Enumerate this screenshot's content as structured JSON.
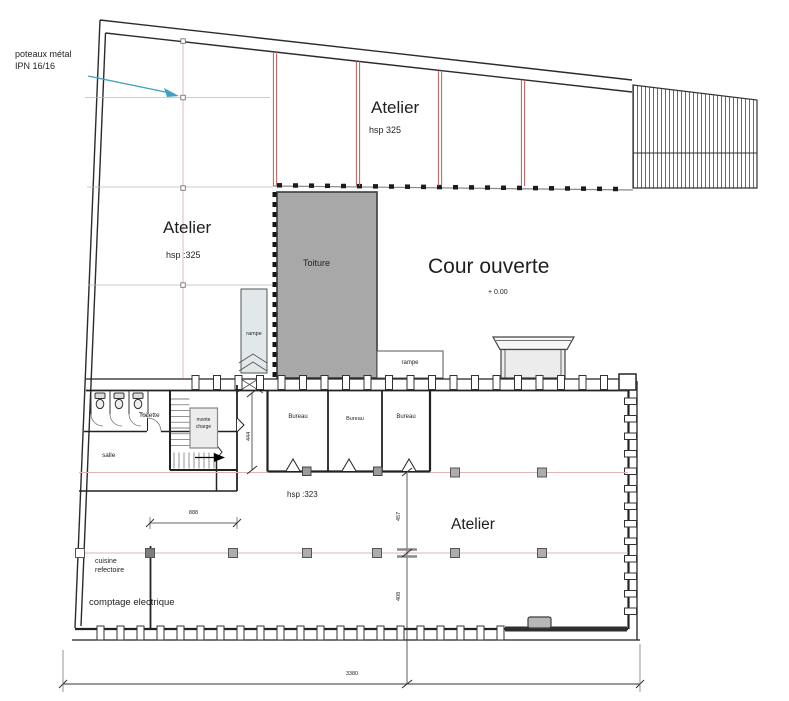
{
  "plan": {
    "annotation": {
      "line1": "poteaux métal",
      "line2": "IPN 16/16"
    },
    "upper_workshop": {
      "name": "Atelier",
      "ceiling": "hsp 325"
    },
    "left_workshop": {
      "name": "Atelier",
      "ceiling": "hsp :325"
    },
    "courtyard": {
      "name": "Cour ouverte",
      "level": "+ 0.00"
    },
    "roof": {
      "name": "Toiture"
    },
    "ramp_left": {
      "name": "rampe"
    },
    "ramp_right": {
      "name": "rampe"
    },
    "toilets": {
      "name": "Toilette"
    },
    "hall": {
      "name": "salle"
    },
    "freight_lift": {
      "line1": "monte",
      "line2": "charge"
    },
    "offices": [
      {
        "name": "Bureau"
      },
      {
        "name": "Bureau"
      },
      {
        "name": "Bureau"
      }
    ],
    "lower_workshop": {
      "name": "Atelier",
      "ceiling": "hsp :323"
    },
    "kitchen": {
      "line1": "cuisine",
      "line2": "refectoire"
    },
    "electrical": {
      "name": "comptage electrique"
    },
    "dimensions": {
      "stair_bay": "444",
      "hall_width": "888",
      "bay_upper": "457",
      "bay_lower": "408",
      "total_width": "3380"
    }
  },
  "colors": {
    "wall": "#2b2b2b",
    "partition_red": "#c05a5a",
    "axis_pink": "#dfb3b3",
    "roof_fill": "#a8a8a8",
    "ramp_fill": "#e1e8e9",
    "lift_fill": "#ececec",
    "leader_blue": "#42a0c2",
    "column_gray": "#adadad"
  }
}
